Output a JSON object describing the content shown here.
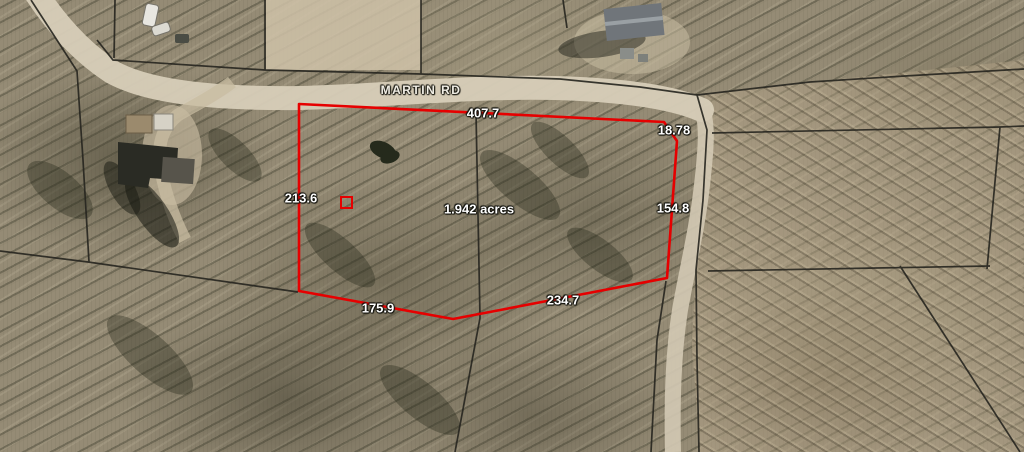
{
  "map": {
    "road_label": "MARTIN RD",
    "parcel": {
      "area_label": "1.942 acres",
      "dimensions": {
        "top": "407.7",
        "top_right": "18.78",
        "right": "154.8",
        "bottom_right": "234.7",
        "bottom_left": "175.9",
        "left": "213.6"
      }
    },
    "colors": {
      "parcel_boundary": "#e60000",
      "parcel_lines": "#26251f",
      "label_text": "#ffffff",
      "road_surface": "#d7cdb8"
    }
  }
}
